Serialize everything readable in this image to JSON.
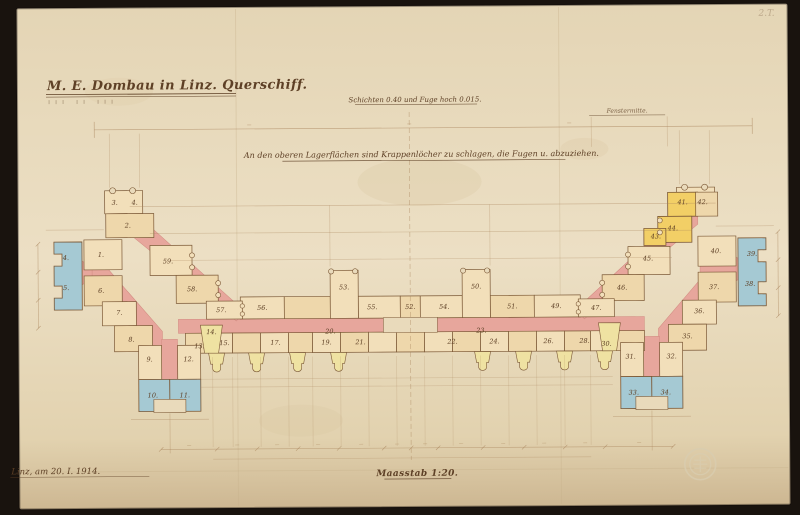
{
  "page": {
    "title": "M. E. Dombau in Linz. Querschiff.",
    "note_courses": "Schichten 0.40 und Fuge hoch 0.015.",
    "note_axis": "Fenstermitte.",
    "instruction": "An den oberen Lagerflächen sind Krappenlöcher zu schlagen, die Fugen u. abzuziehen.",
    "scale": "Maasstab 1:20.",
    "date": "Linz, am 20. I. 1914.",
    "corner_mark": "2.T."
  },
  "colors": {
    "paper": "#e9dabb",
    "ink": "#7b5836",
    "label": "#5e4026",
    "stone": "#f2dfba",
    "stone2": "#eed7ab",
    "pink": "#e7a69c",
    "pinkline": "#d18a80",
    "blue": "#a5c9d3",
    "yellow": "#f2cf66",
    "paleyellow": "#efe2a2",
    "dim": "#a9845c",
    "crease": "#c6b08a",
    "background": "#1e1712"
  },
  "stones": [
    {
      "t": "3.",
      "x": 115,
      "y": 203
    },
    {
      "t": "4.",
      "x": 135,
      "y": 203
    },
    {
      "t": "2.",
      "x": 128,
      "y": 226
    },
    {
      "t": "59.",
      "x": 168,
      "y": 262
    },
    {
      "t": "58.",
      "x": 192,
      "y": 290
    },
    {
      "t": "57.",
      "x": 221,
      "y": 311
    },
    {
      "t": "1.",
      "x": 101,
      "y": 255
    },
    {
      "t": "6.",
      "x": 101,
      "y": 291
    },
    {
      "t": "4.",
      "x": 66,
      "y": 258
    },
    {
      "t": "5.",
      "x": 66,
      "y": 288
    },
    {
      "t": "7.",
      "x": 119,
      "y": 313
    },
    {
      "t": "8.",
      "x": 131,
      "y": 340
    },
    {
      "t": "9.",
      "x": 149,
      "y": 360
    },
    {
      "t": "12.",
      "x": 188,
      "y": 360
    },
    {
      "t": "10.",
      "x": 152,
      "y": 396
    },
    {
      "t": "11.",
      "x": 184,
      "y": 396
    },
    {
      "t": "13.",
      "x": 199,
      "y": 347
    },
    {
      "t": "14.",
      "x": 211,
      "y": 333
    },
    {
      "t": "56.",
      "x": 262,
      "y": 309
    },
    {
      "t": "55.",
      "x": 372,
      "y": 309
    },
    {
      "t": "52.",
      "x": 410,
      "y": 309
    },
    {
      "t": "54.",
      "x": 444,
      "y": 309
    },
    {
      "t": "53.",
      "x": 344,
      "y": 289
    },
    {
      "t": "50.",
      "x": 476,
      "y": 289
    },
    {
      "t": "51.",
      "x": 512,
      "y": 309
    },
    {
      "t": "49.",
      "x": 556,
      "y": 309
    },
    {
      "t": "15.",
      "x": 224,
      "y": 344
    },
    {
      "t": "17.",
      "x": 275,
      "y": 344
    },
    {
      "t": "19.",
      "x": 326,
      "y": 344
    },
    {
      "t": "21.",
      "x": 360,
      "y": 344
    },
    {
      "t": "22.",
      "x": 452,
      "y": 344
    },
    {
      "t": "24.",
      "x": 494,
      "y": 344
    },
    {
      "t": "26.",
      "x": 548,
      "y": 344
    },
    {
      "t": "28.",
      "x": 584,
      "y": 344
    },
    {
      "t": "20.",
      "x": 330,
      "y": 333
    },
    {
      "t": "23.",
      "x": 481,
      "y": 333
    },
    {
      "t": "30.",
      "x": 606,
      "y": 347
    },
    {
      "t": "41.",
      "x": 683,
      "y": 206
    },
    {
      "t": "42.",
      "x": 703,
      "y": 206
    },
    {
      "t": "44.",
      "x": 673,
      "y": 232
    },
    {
      "t": "43.",
      "x": 656,
      "y": 240
    },
    {
      "t": "45.",
      "x": 648,
      "y": 262
    },
    {
      "t": "46.",
      "x": 622,
      "y": 291
    },
    {
      "t": "47.",
      "x": 596,
      "y": 311
    },
    {
      "t": "40.",
      "x": 716,
      "y": 255
    },
    {
      "t": "37.",
      "x": 714,
      "y": 291
    },
    {
      "t": "39.",
      "x": 752,
      "y": 258
    },
    {
      "t": "38.",
      "x": 750,
      "y": 288
    },
    {
      "t": "36.",
      "x": 699,
      "y": 315
    },
    {
      "t": "35.",
      "x": 687,
      "y": 340
    },
    {
      "t": "31.",
      "x": 630,
      "y": 360
    },
    {
      "t": "32.",
      "x": 671,
      "y": 360
    },
    {
      "t": "33.",
      "x": 633,
      "y": 396
    },
    {
      "t": "34.",
      "x": 665,
      "y": 396
    }
  ]
}
